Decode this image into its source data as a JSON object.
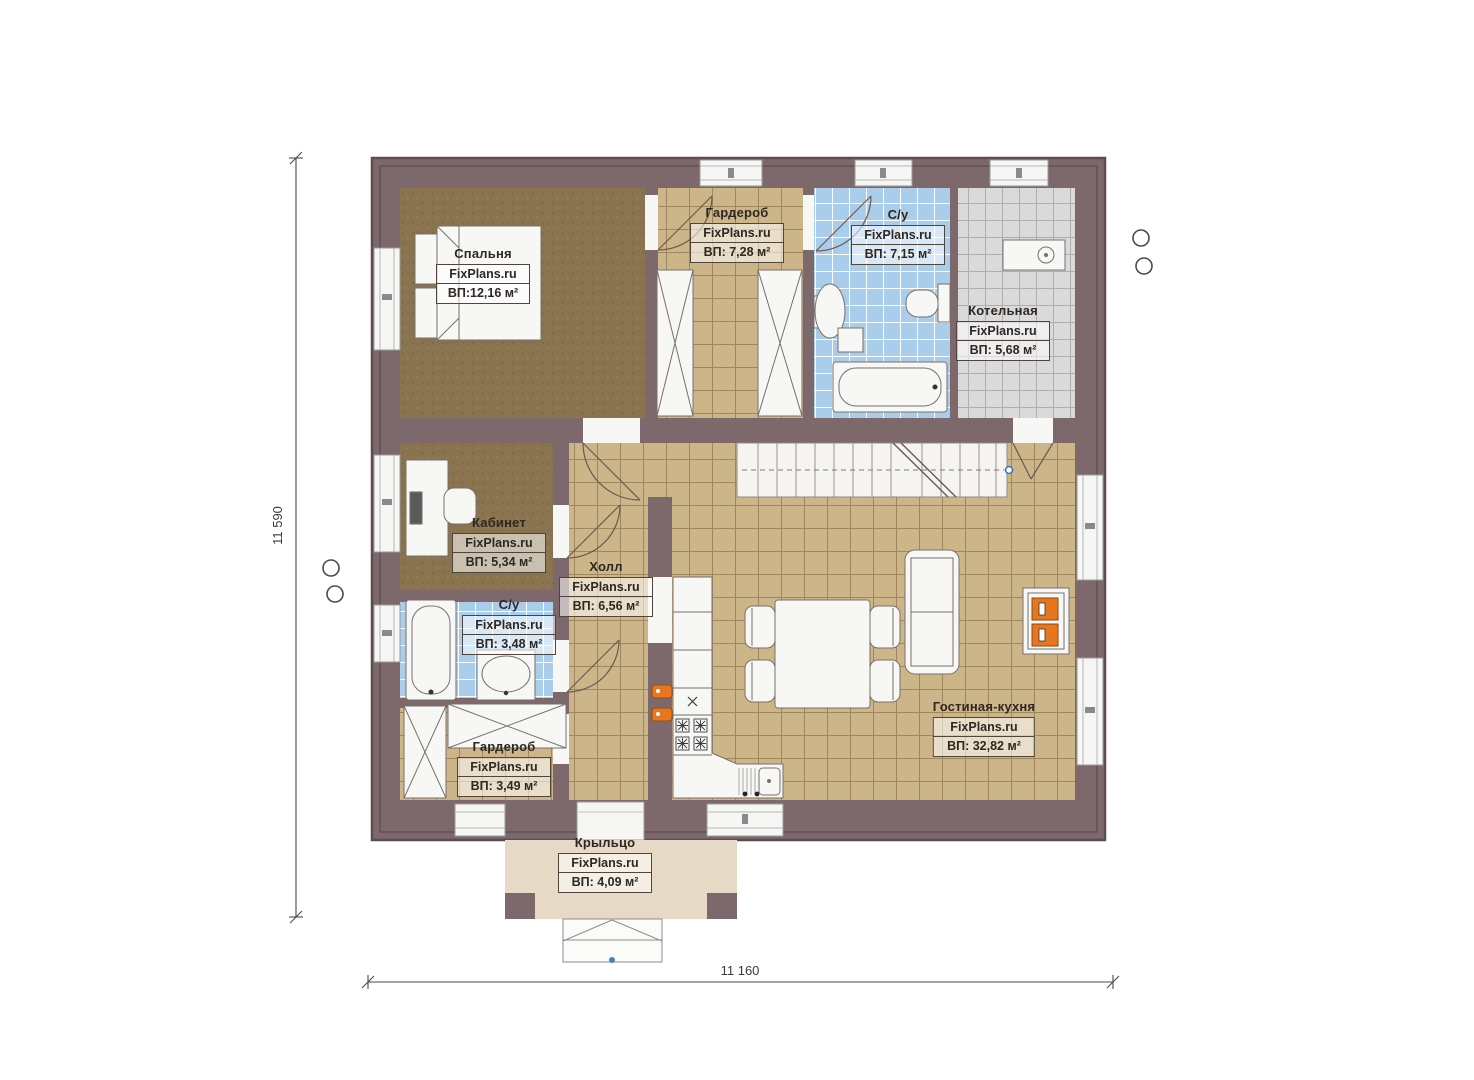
{
  "plan_title": "Floor plan (first floor)",
  "watermark": "FixPlans.ru",
  "dimensions": {
    "left_total": "11 590",
    "bottom_total": "11 160"
  },
  "rooms": [
    {
      "id": "bedroom",
      "name": "Спальня",
      "watermark": "FixPlans.ru",
      "area": "ВП:12,16 м²"
    },
    {
      "id": "wardrobe-top",
      "name": "Гардероб",
      "watermark": "FixPlans.ru",
      "area": "ВП: 7,28 м²"
    },
    {
      "id": "bathroom-top",
      "name": "С/у",
      "watermark": "FixPlans.ru",
      "area": "ВП: 7,15 м²"
    },
    {
      "id": "boiler-room",
      "name": "Котельная",
      "watermark": "FixPlans.ru",
      "area": "ВП: 5,68 м²"
    },
    {
      "id": "office",
      "name": "Кабинет",
      "watermark": "FixPlans.ru",
      "area": "ВП: 5,34 м²"
    },
    {
      "id": "hall",
      "name": "Холл",
      "watermark": "FixPlans.ru",
      "area": "ВП: 6,56 м²"
    },
    {
      "id": "bathroom-lower",
      "name": "С/у",
      "watermark": "FixPlans.ru",
      "area": "ВП: 3,48 м²"
    },
    {
      "id": "wardrobe-lower",
      "name": "Гардероб",
      "watermark": "FixPlans.ru",
      "area": "ВП: 3,49 м²"
    },
    {
      "id": "living-kitchen",
      "name": "Гостиная-кухня",
      "watermark": "FixPlans.ru",
      "area": "ВП: 32,82 м²"
    },
    {
      "id": "porch",
      "name": "Крыльцо",
      "watermark": "FixPlans.ru",
      "area": "ВП: 4,09 м²"
    }
  ],
  "colors": {
    "wall": "#7d686c",
    "wall_outline": "#5d4d50",
    "carpet": "#8a734f",
    "tile_tan": "#cdb58a",
    "tile_blue": "#abcdec",
    "tile_gray": "#dadada",
    "porch": "#e6d9c5",
    "fixture": "#f7f7f5",
    "accent_orange": "#e8761e",
    "dim_line": "#4a4a4a"
  }
}
